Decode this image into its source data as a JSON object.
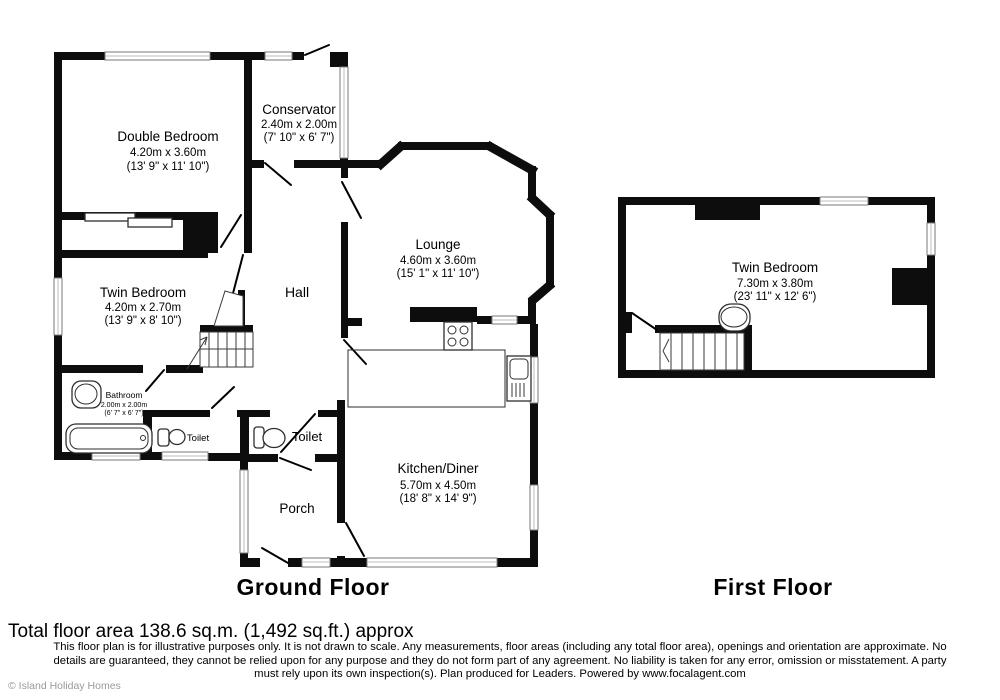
{
  "meta": {
    "copyright": "© Island Holiday Homes",
    "total_area": "Total floor area 138.6 sq.m. (1,492 sq.ft.) approx",
    "disclaimer_line1": "This floor plan is for illustrative purposes only. It is not drawn to scale. Any measurements, floor areas (including any total floor area), openings and orientation are approximate. No",
    "disclaimer_line2": "details are guaranteed, they cannot be relied upon for any purpose and they do not form part of any agreement. No liability is taken for any error, omission or misstatement. A party",
    "disclaimer_line3": "must rely upon its own inspection(s). Plan produced for Leaders. Powered by www.focalagent.com"
  },
  "ground_floor": {
    "title": "Ground Floor",
    "rooms": {
      "double_bedroom": {
        "name": "Double Bedroom",
        "metric": "4.20m x 3.60m",
        "imperial": "(13' 9\" x 11' 10\")"
      },
      "conservatory": {
        "name": "Conservator",
        "metric": "2.40m x 2.00m",
        "imperial": "(7' 10\" x 6' 7\")"
      },
      "lounge": {
        "name": "Lounge",
        "metric": "4.60m x 3.60m",
        "imperial": "(15' 1\" x 11' 10\")"
      },
      "twin_bedroom": {
        "name": "Twin Bedroom",
        "metric": "4.20m x 2.70m",
        "imperial": "(13' 9\" x 8' 10\")"
      },
      "hall": {
        "name": "Hall"
      },
      "bathroom": {
        "name": "Bathroom",
        "metric": "2.00m x 2.00m",
        "imperial": "(6' 7\" x 6' 7\")"
      },
      "toilet_small": {
        "name": "Toilet"
      },
      "toilet": {
        "name": "Toilet"
      },
      "porch": {
        "name": "Porch"
      },
      "kitchen_diner": {
        "name": "Kitchen/Diner",
        "metric": "5.70m x 4.50m",
        "imperial": "(18' 8\" x 14' 9\")"
      }
    }
  },
  "first_floor": {
    "title": "First Floor",
    "rooms": {
      "twin_bedroom": {
        "name": "Twin Bedroom",
        "metric": "7.30m x 3.80m",
        "imperial": "(23' 11\" x 12' 6\")"
      }
    }
  },
  "colors": {
    "wall": "#0d0d0d",
    "window_stroke": "#7a7a7a",
    "copyright": "#9a9a9a"
  }
}
